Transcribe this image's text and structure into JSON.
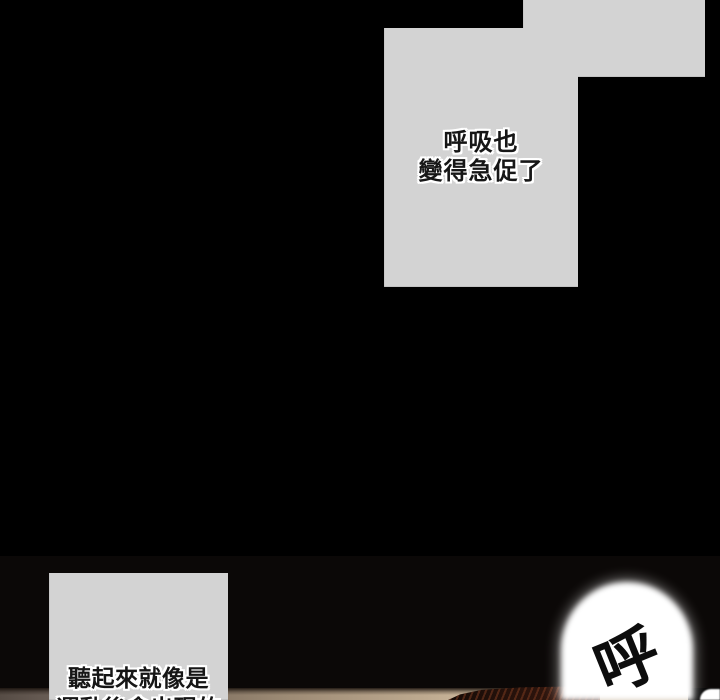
{
  "comic": {
    "balloon_top": {
      "line1": "呼吸也",
      "line2": "變得急促了"
    },
    "balloon_bottom": {
      "line1": "聽起來就像是",
      "line2": "運動後會出現的"
    },
    "sfx": {
      "text": "呼"
    }
  },
  "colors": {
    "background": "#000000",
    "panel_gray": "#d3d3d3",
    "text": "#161616",
    "text_outline": "#ffffff",
    "floor_dark": "#6b5f57",
    "floor_tan": "#c7b398",
    "hair_dark": "#1d0f09",
    "hair_highlight": "#7a3a20",
    "bubble_white": "#ffffff"
  }
}
